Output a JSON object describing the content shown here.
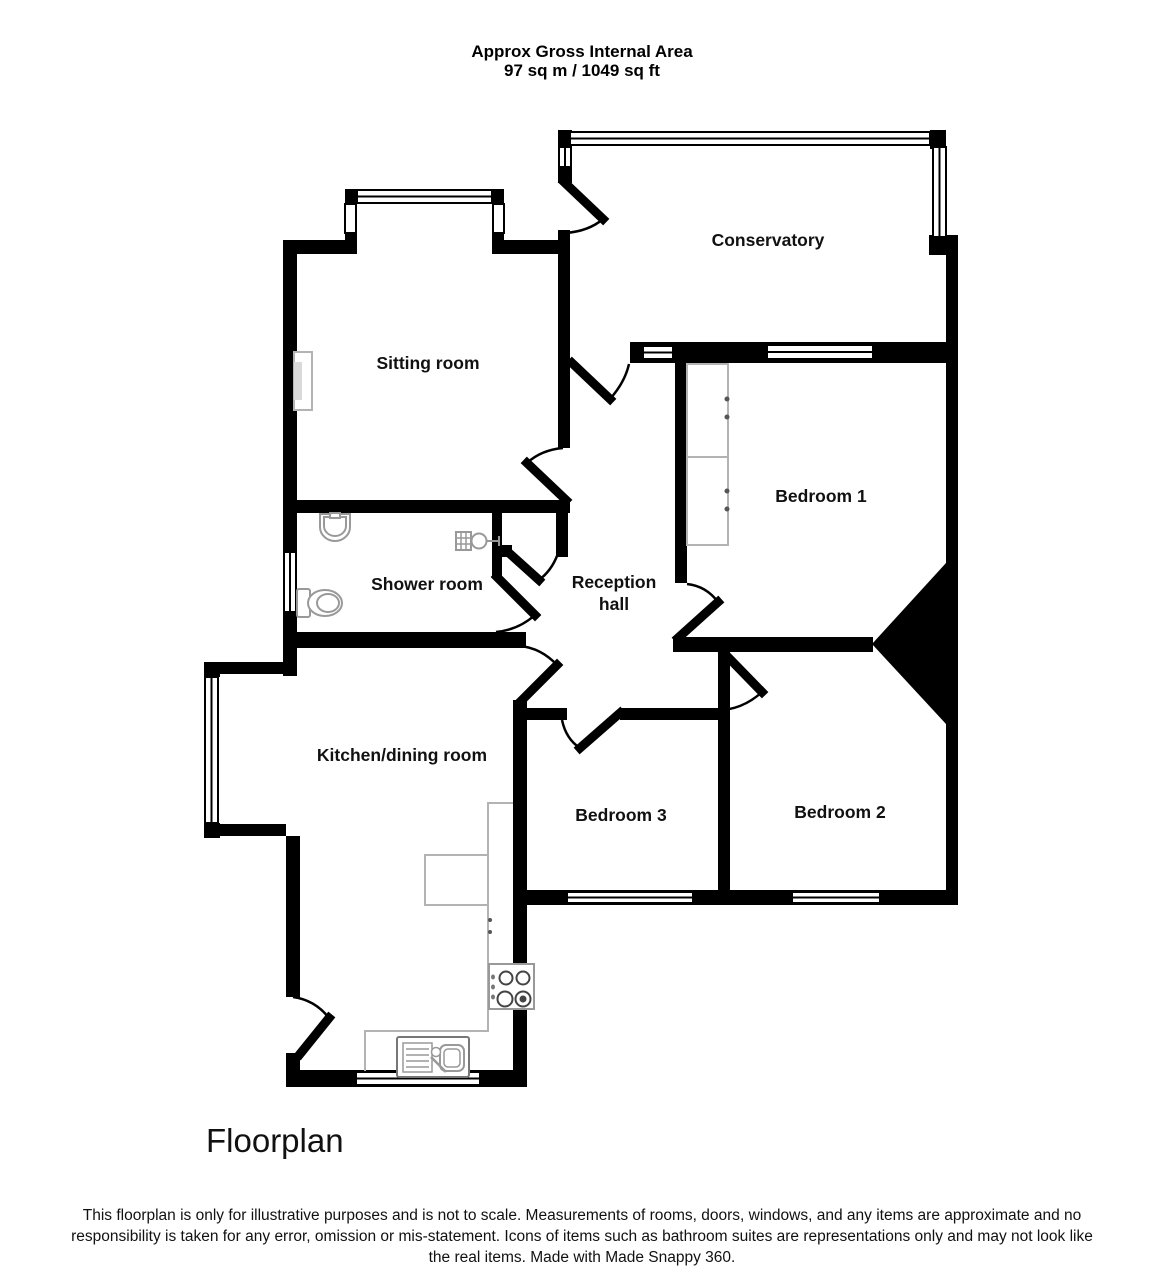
{
  "header": {
    "line1": "Approx Gross Internal Area",
    "line2": "97 sq m / 1049 sq ft"
  },
  "rooms": {
    "conservatory": {
      "label": "Conservatory"
    },
    "sitting": {
      "label": "Sitting room"
    },
    "shower": {
      "label": "Shower room"
    },
    "reception": {
      "label": "Reception hall",
      "line1": "Reception",
      "line2": "hall"
    },
    "bedroom1": {
      "label": "Bedroom 1"
    },
    "kitchen": {
      "label": "Kitchen/dining room"
    },
    "bedroom3": {
      "label": "Bedroom 3"
    },
    "bedroom2": {
      "label": "Bedroom 2"
    }
  },
  "footer": {
    "title": "Floorplan",
    "disclaimer": "This floorplan is only for illustrative purposes and is not to scale. Measurements of rooms, doors, windows, and any items are approximate and no responsibility is taken for any error, omission or mis-statement. Icons of items such as bathroom suites are representations only and may not look like the real items. Made with Made Snappy 360."
  },
  "colors": {
    "wall": "#000000",
    "fixture_outline": "#b3b3b3",
    "background": "#ffffff"
  }
}
